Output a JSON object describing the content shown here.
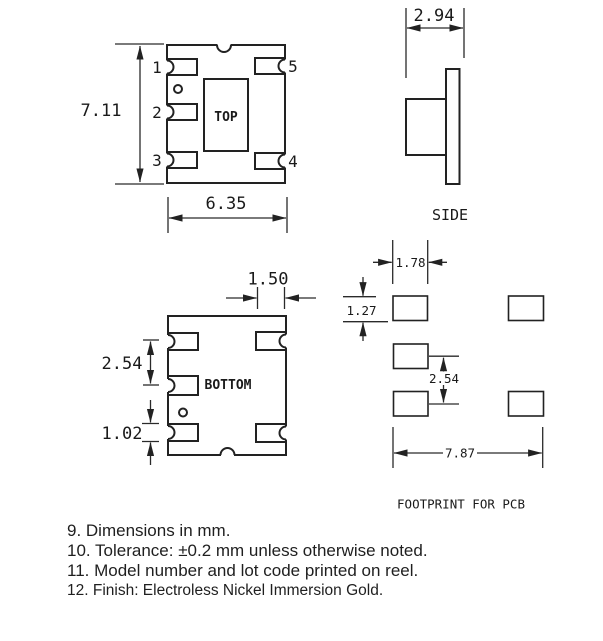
{
  "top_view": {
    "label": "TOP",
    "pins": {
      "p1": "1",
      "p2": "2",
      "p3": "3",
      "p4": "4",
      "p5": "5"
    },
    "dim_height": "7.11",
    "dim_width": "6.35"
  },
  "side_view": {
    "label": "SIDE",
    "dim_width": "2.94"
  },
  "bottom_view": {
    "label": "BOTTOM",
    "dim_pad_length": "1.50",
    "dim_pitch": "2.54",
    "dim_pad_width": "1.02"
  },
  "footprint": {
    "label": "FOOTPRINT FOR PCB",
    "dim_pad_width": "1.78",
    "dim_pad_height": "1.27",
    "dim_pitch": "2.54",
    "dim_span": "7.87"
  },
  "notes": [
    "9. Dimensions in mm.",
    "10. Tolerance: ±0.2 mm unless otherwise noted.",
    "11. Model number and lot code printed on reel.",
    "12. Finish: Electroless Nickel Immersion Gold."
  ],
  "colors": {
    "ink": "#222222",
    "background": "#ffffff"
  }
}
